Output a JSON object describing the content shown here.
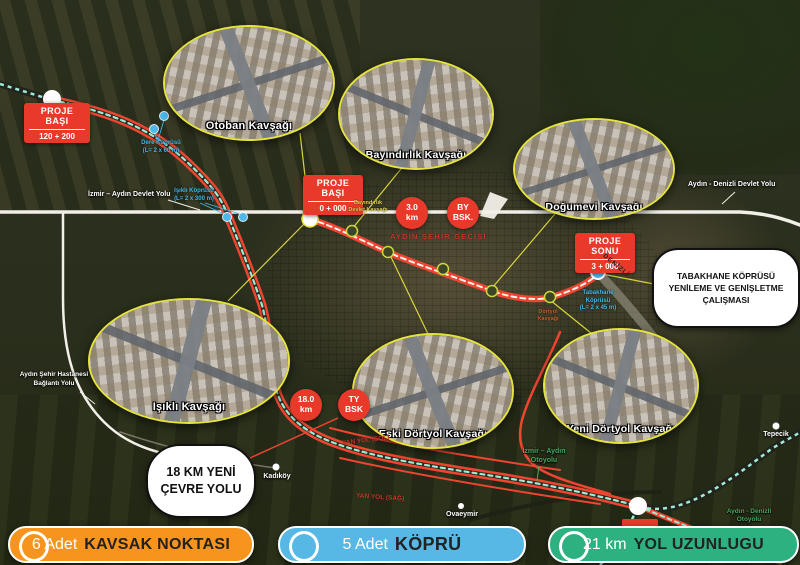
{
  "map": {
    "insets": [
      {
        "label": "Otoban Kavşağı"
      },
      {
        "label": "Bayındırlık Kavşağı"
      },
      {
        "label": "Doğumevi Kavşağı"
      },
      {
        "label": "Işıklı Kavşağı"
      },
      {
        "label": "Eski Dörtyol Kavşağı"
      },
      {
        "label": "Yeni Dörtyol Kavşağı"
      }
    ],
    "badges": {
      "basi1": {
        "line1": "PROJE",
        "line2": "BAŞI",
        "km": "120 + 200"
      },
      "basi0": {
        "line1": "PROJE",
        "line2": "BAŞI",
        "km": "0 + 000"
      },
      "sonu": {
        "line1": "PROJE",
        "line2": "SONU",
        "km": "3 + 000"
      }
    },
    "circles": {
      "c3": {
        "l1": "3.0",
        "l2": "km"
      },
      "cby": {
        "l1": "BY",
        "l2": "BSK."
      },
      "c18": {
        "l1": "18.0",
        "l2": "km"
      },
      "cty": {
        "l1": "TY",
        "l2": "BSK"
      }
    },
    "callouts": {
      "tabakhane": "TABAKHANE KÖPRÜSÜ YENİLEME VE GENİŞLETME ÇALIŞMASI",
      "cevre": "18 KM YENİ ÇEVRE YOLU"
    },
    "roads": {
      "izmir_aydin_devlet": "İzmir – Aydın Devlet Yolu",
      "aydin_denizli_devlet": "Aydın - Denizli Devlet Yolu",
      "hastane1": "Aydın Şehir Hastanesi",
      "hastane2": "Bağlantı Yolu",
      "otoyol_ia1": "İzmir – Aydın",
      "otoyol_ia2": "Otoyolu",
      "otoyol_ad1": "Aydın - Denizli",
      "otoyol_ad2": "Otoyolu",
      "sehir_gecisi": "AYDIN ŞEHİR GEÇİŞİ",
      "yanyol_sol": "YAN YOL (SOL)",
      "yanyol_sag": "YAN YOL (SAĞ)",
      "denizli": "DENİZLİ"
    },
    "bridges": {
      "dere1": "Dere Köprüsü",
      "dere2": "(L= 2 x 60 m)",
      "isikli1": "Işıklı Köprüsü",
      "isikli2": "(L= 2 x 300 m)",
      "tab1": "Tabakhane",
      "tab2": "Köprüsü",
      "tab3": "(L= 2 x 45 m)"
    },
    "places": {
      "kadikoy": "Kadıköy",
      "ovaeymir": "Ovaeymir",
      "tepecik": "Tepecik"
    },
    "junctions": {
      "b1": "Bayındırlık",
      "b2": "Devlet Kavşağı",
      "d1": "Dörtyol",
      "d2": "Kavşağı"
    }
  },
  "legend": {
    "items": [
      {
        "count": "6 Adet",
        "label": "KAVSAK NOKTASI",
        "color": "#f7941e"
      },
      {
        "count": "5 Adet",
        "label": "KÖPRÜ",
        "color": "#57b8e6"
      },
      {
        "count": "21 km",
        "label": "YOL UZUNLUGU",
        "color": "#2eb180"
      }
    ]
  },
  "colors": {
    "route_red": "#ef4430",
    "teal_dash": "#9fe9d8",
    "accent_yellow": "#e5e33d",
    "bridge_blue": "#45b6e8",
    "badge_red": "#e8392b"
  }
}
